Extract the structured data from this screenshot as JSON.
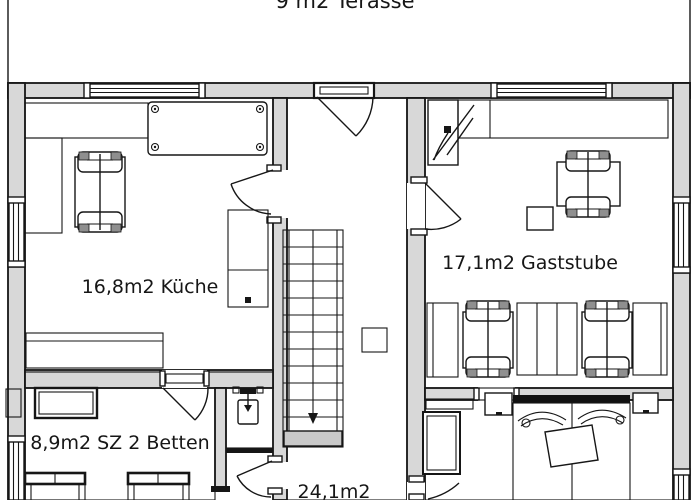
{
  "plan": {
    "labels": {
      "terrace": "9 m2 Terasse",
      "kitchen": "16,8m2 Küche",
      "gaststube": "17,1m2 Gaststube",
      "bedroom_sz": "8,9m2 SZ 2 Betten",
      "hall_area": "24,1m2"
    },
    "colors": {
      "background": "#ffffff",
      "wall_fill": "#d8d8d8",
      "line": "#161616",
      "stair_landing": "#c9c9c9",
      "chair_back": "#8f8f8f",
      "headboard": "#111111"
    }
  }
}
